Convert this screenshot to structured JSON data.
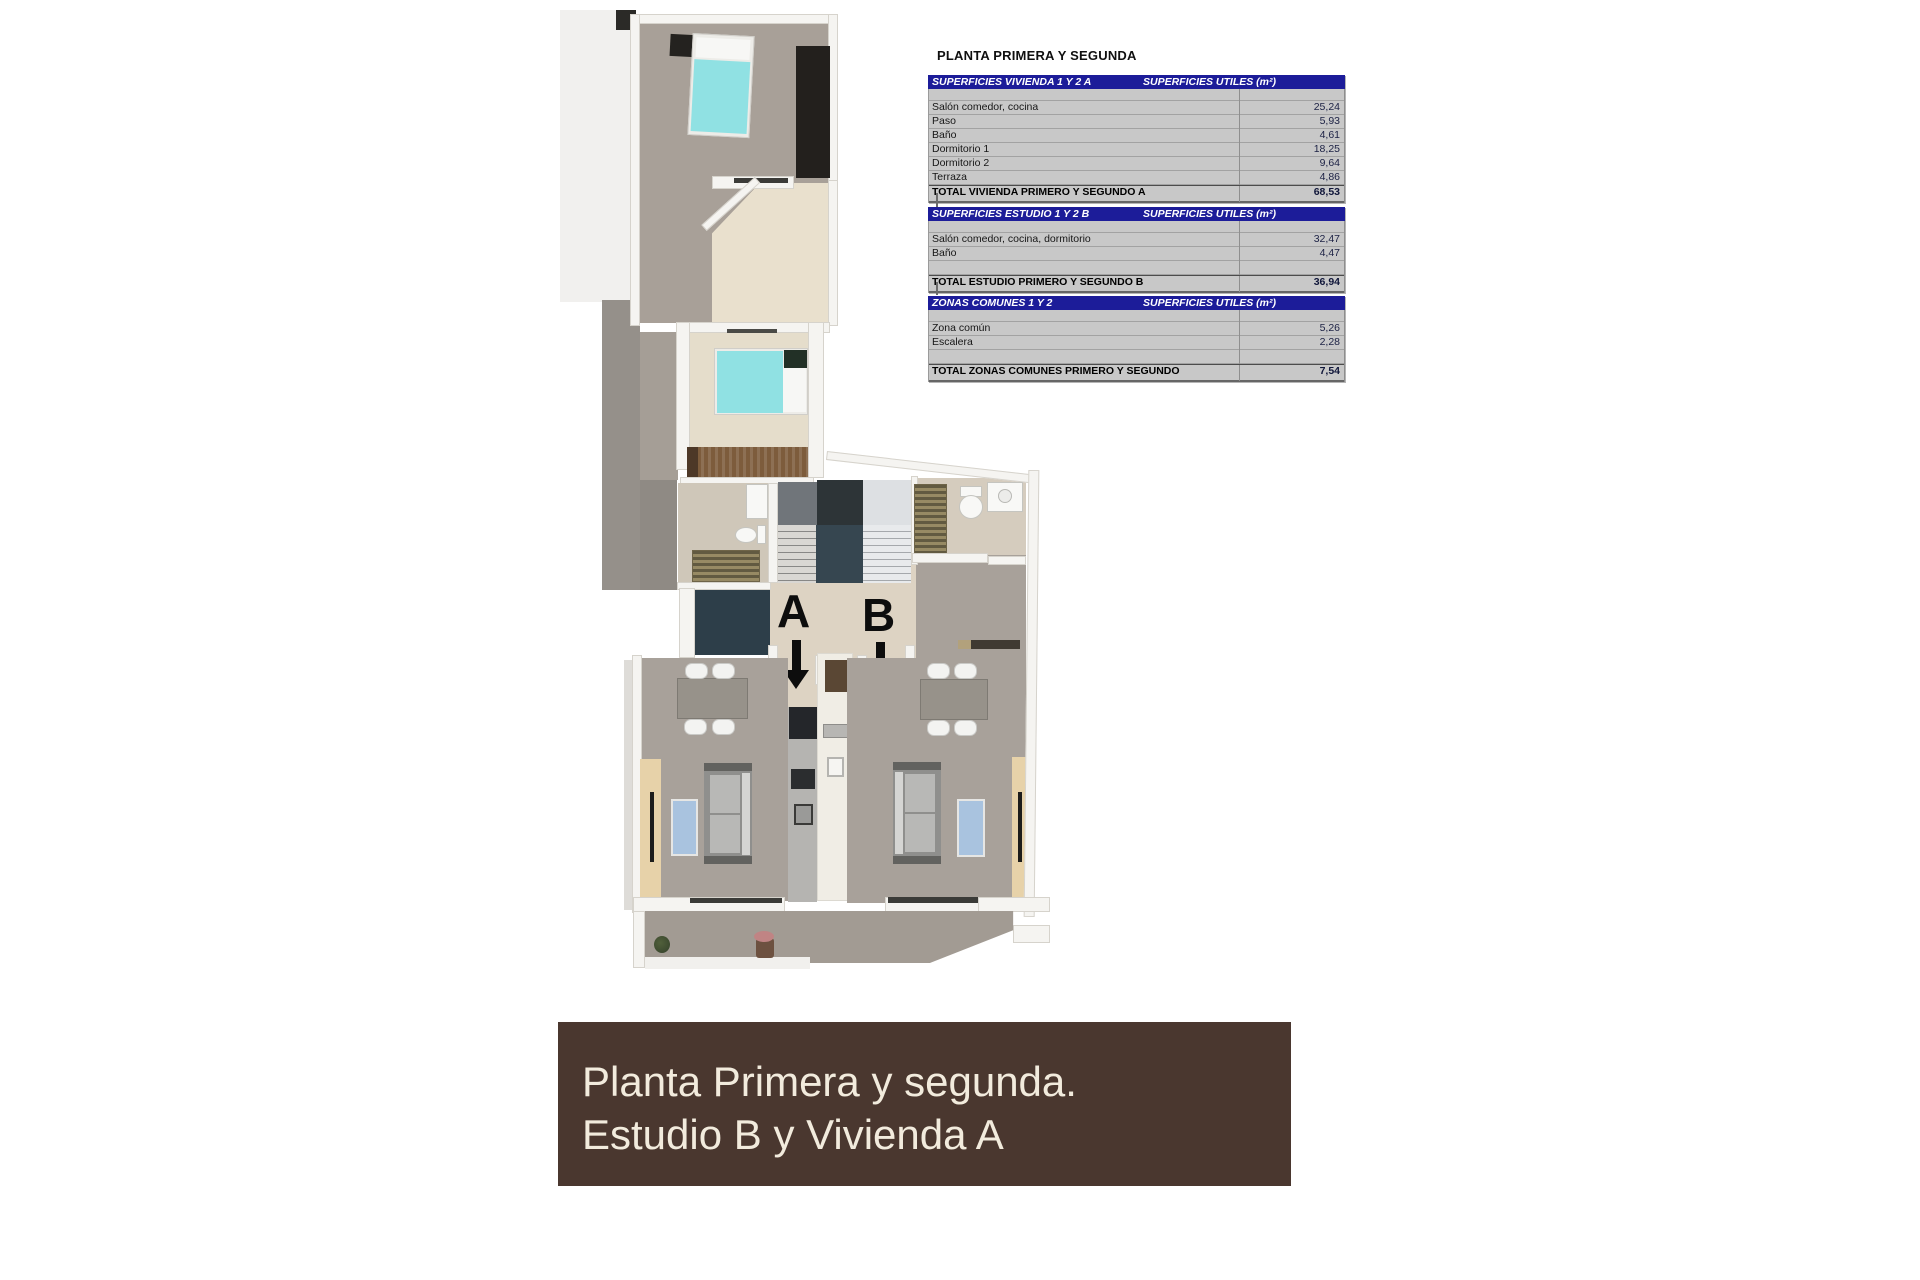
{
  "sheet": {
    "title": "PLANTA PRIMERA Y SEGUNDA"
  },
  "tables": [
    {
      "header_left": "SUPERFICIES VIVIENDA 1 Y 2 A",
      "header_right": "SUPERFICIES UTILES  (m²)",
      "rows": [
        {
          "label": "Salón comedor, cocina",
          "value": "25,24"
        },
        {
          "label": "Paso",
          "value": "5,93"
        },
        {
          "label": "Baño",
          "value": "4,61"
        },
        {
          "label": "Dormitorio 1",
          "value": "18,25"
        },
        {
          "label": "Dormitorio 2",
          "value": "9,64"
        },
        {
          "label": "Terraza",
          "value": "4,86"
        }
      ],
      "total_label": "TOTAL VIVIENDA PRIMERO Y SEGUNDO A",
      "total_value": "68,53"
    },
    {
      "header_left": "SUPERFICIES ESTUDIO 1 Y 2 B",
      "header_right": "SUPERFICIES UTILES  (m²)",
      "rows": [
        {
          "label": "Salón comedor, cocina, dormitorio",
          "value": "32,47"
        },
        {
          "label": "Baño",
          "value": "4,47"
        },
        {
          "label": "",
          "value": ""
        }
      ],
      "total_label": "TOTAL ESTUDIO PRIMERO Y SEGUNDO B",
      "total_value": "36,94"
    },
    {
      "header_left": "ZONAS COMUNES 1 Y 2",
      "header_right": "SUPERFICIES UTILES  (m²)",
      "rows": [
        {
          "label": "Zona común",
          "value": "5,26"
        },
        {
          "label": "Escalera",
          "value": "2,28"
        },
        {
          "label": "",
          "value": ""
        }
      ],
      "total_label": "TOTAL ZONAS COMUNES PRIMERO Y SEGUNDO",
      "total_value": "7,54"
    }
  ],
  "floorplan": {
    "unit_a_label": "A",
    "unit_b_label": "B"
  },
  "banner": {
    "line1": "Planta Primera y segunda.",
    "line2": "Estudio B y Vivienda A"
  },
  "colors": {
    "table_header_navy": "#1c1c99",
    "table_body_gray": "#c8c8c8",
    "banner_brown": "#4a372f",
    "banner_text": "#f2ebdd",
    "bed_cyan": "#90e1e3",
    "floor_gray": "#a8a098",
    "floor_beige": "#e5ddcb"
  }
}
